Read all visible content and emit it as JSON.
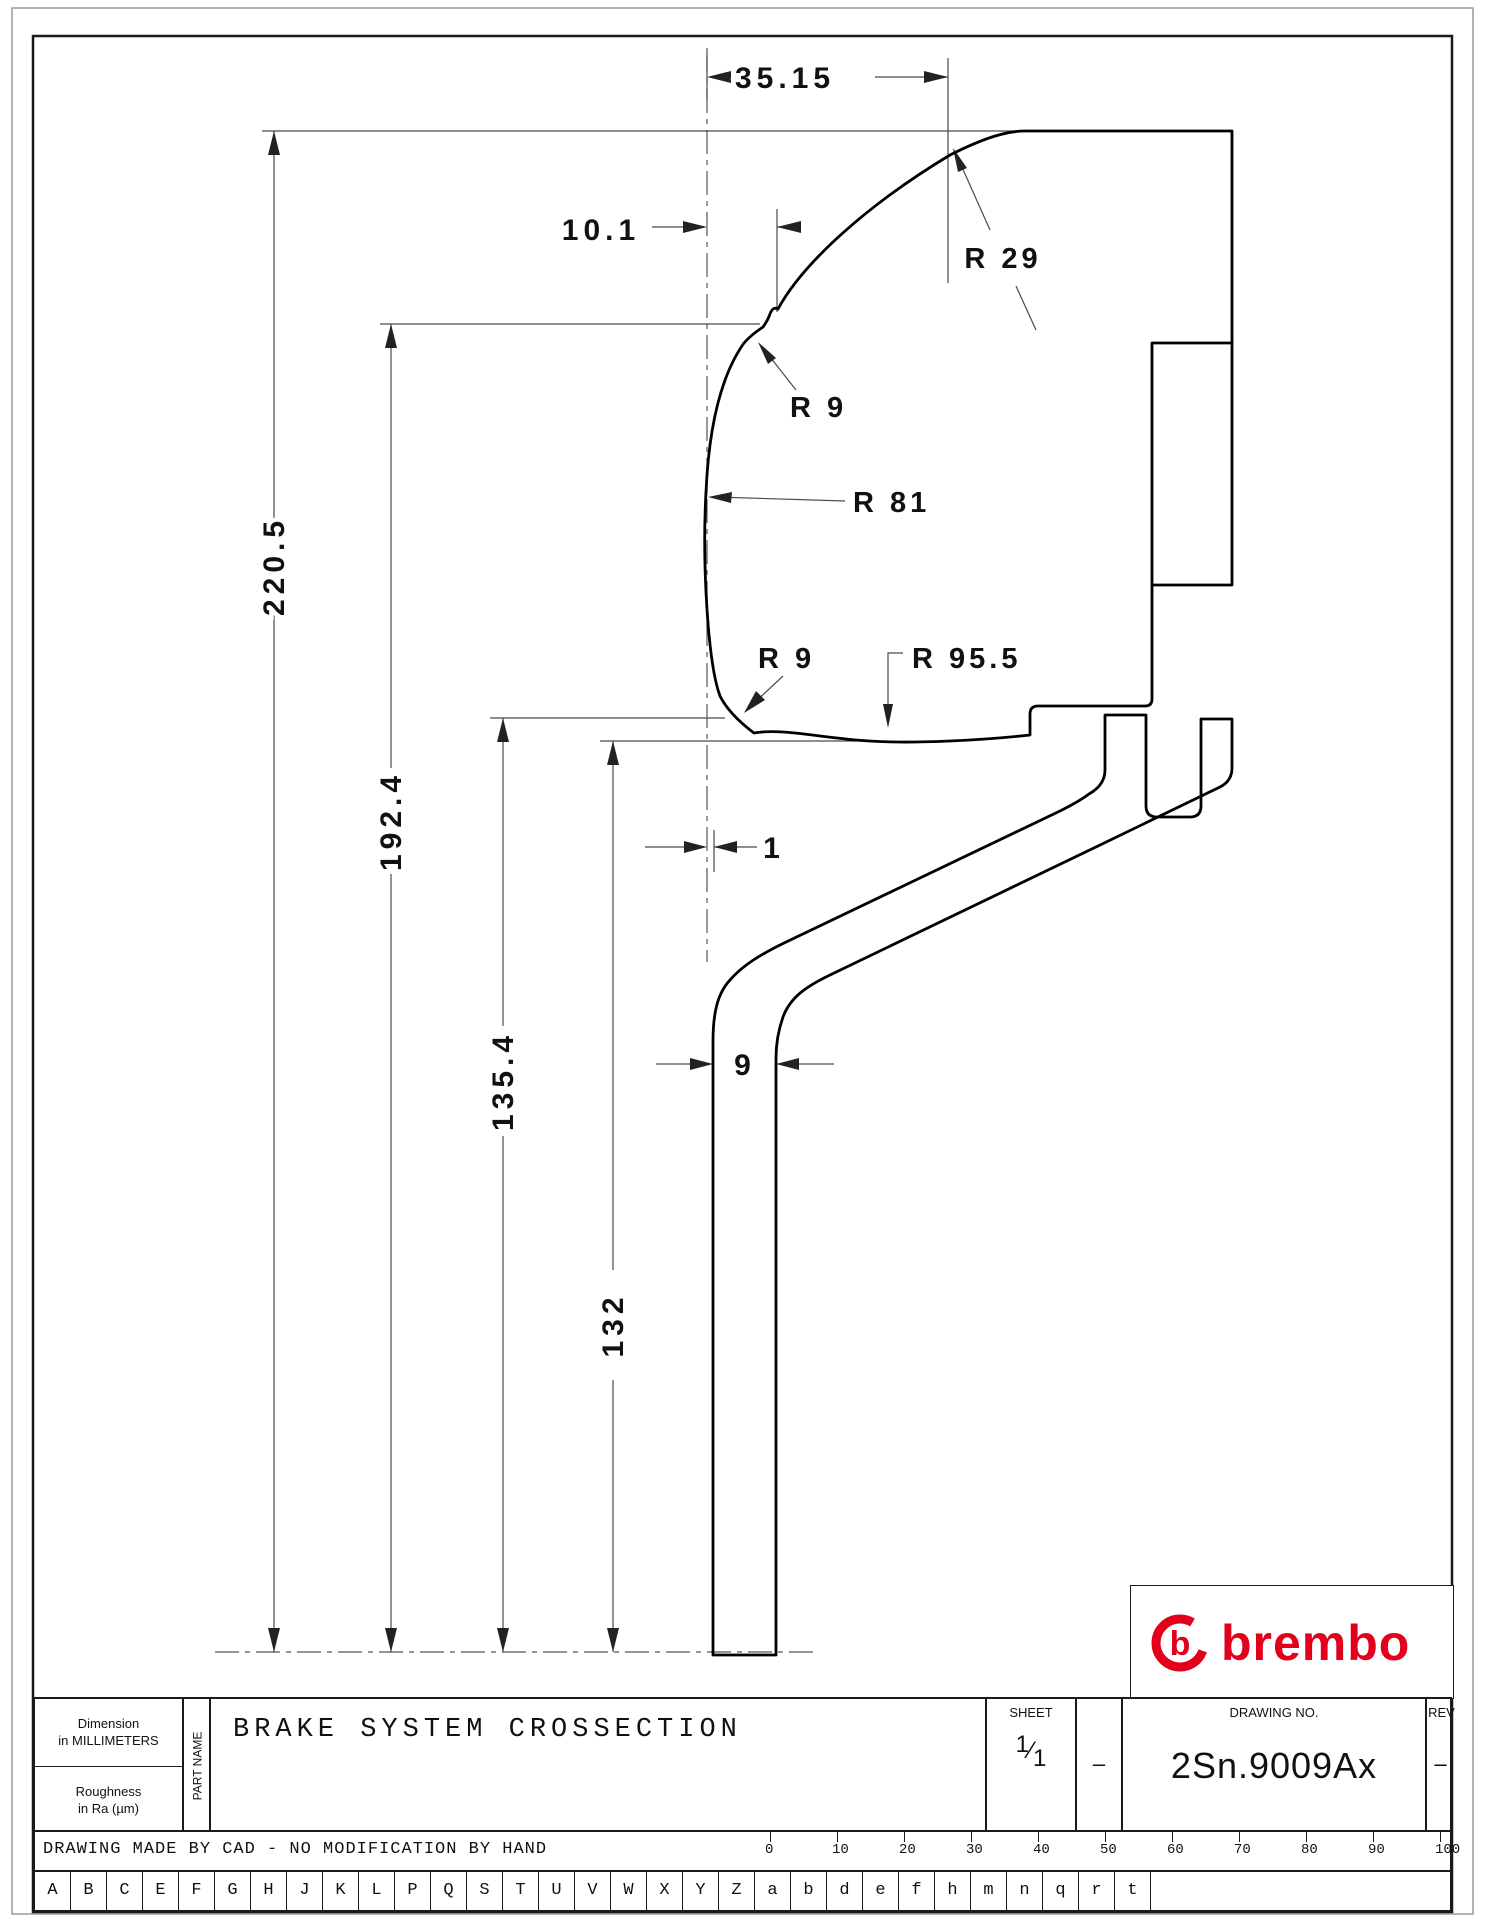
{
  "drawing": {
    "dims": {
      "width_top": "35.15",
      "offset_top": "10.1",
      "height_total": "220.5",
      "height_notch": "192.4",
      "height_pad_face": "135.4",
      "height_disc_face": "132",
      "gap_center": "1",
      "disc_thickness": "9"
    },
    "radii": {
      "r29": "R 29",
      "r9_upper": "R 9",
      "r81": "R 81",
      "r9_lower": "R 9",
      "r95_5": "R 95.5"
    }
  },
  "title_block": {
    "dimension_note_line1": "Dimension",
    "dimension_note_line2": "in MILLIMETERS",
    "roughness_line1": "Roughness",
    "roughness_line2": "in Ra (µm)",
    "part_name_label": "PART NAME",
    "title": "BRAKE SYSTEM CROSSECTION",
    "sheet_label": "SHEET",
    "sheet_num": "1",
    "sheet_den": "1",
    "sheet_dash": "–",
    "drawing_no_label": "DRAWING NO.",
    "drawing_no": "2Sn.9009Ax",
    "rev_label": "REV",
    "rev_value": "–",
    "cad_note": "DRAWING MADE BY CAD - NO MODIFICATION BY HAND"
  },
  "logo": {
    "text": "brembo",
    "glyph": "b",
    "color": "#e2001a"
  },
  "ruler_values": [
    "0",
    "10",
    "20",
    "30",
    "40",
    "50",
    "60",
    "70",
    "80",
    "90",
    "100"
  ],
  "letters": [
    "A",
    "B",
    "C",
    "E",
    "F",
    "G",
    "H",
    "J",
    "K",
    "L",
    "P",
    "Q",
    "S",
    "T",
    "U",
    "V",
    "W",
    "X",
    "Y",
    "Z",
    "a",
    "b",
    "d",
    "e",
    "f",
    "h",
    "m",
    "n",
    "q",
    "r",
    "t"
  ]
}
